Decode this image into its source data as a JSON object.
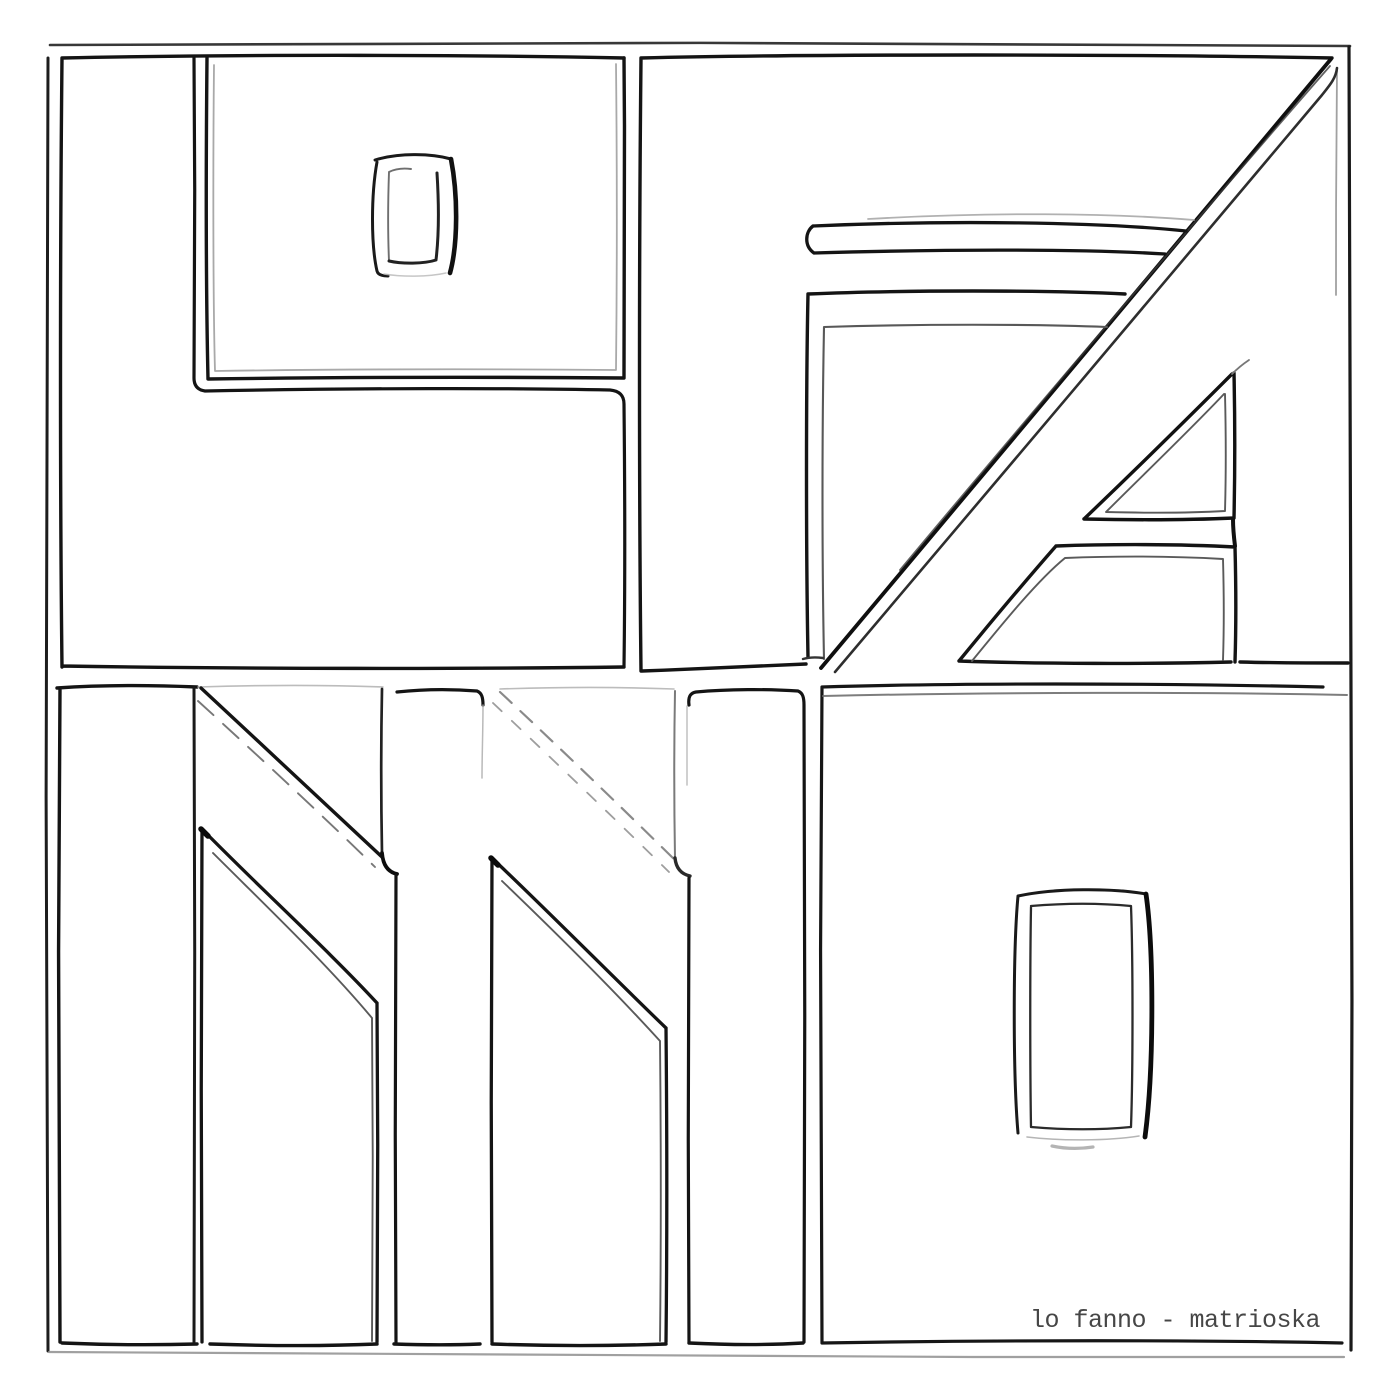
{
  "artwork": {
    "word": "lo fanno",
    "style": "hand-drawn black outline lettering on white, 2x2 grid",
    "quadrants": [
      {
        "position": "top-left",
        "letters": "LO"
      },
      {
        "position": "top-right",
        "letters": "FA"
      },
      {
        "position": "bottom-left",
        "letters": "NN"
      },
      {
        "position": "bottom-right",
        "letters": "O"
      }
    ]
  },
  "caption": {
    "text": "lo fanno - matrioska"
  },
  "colors": {
    "background": "#ffffff",
    "ink": "#141414",
    "ink_soft": "#5a5a5a",
    "ink_faint": "#9a9a9a",
    "caption": "#464646"
  }
}
